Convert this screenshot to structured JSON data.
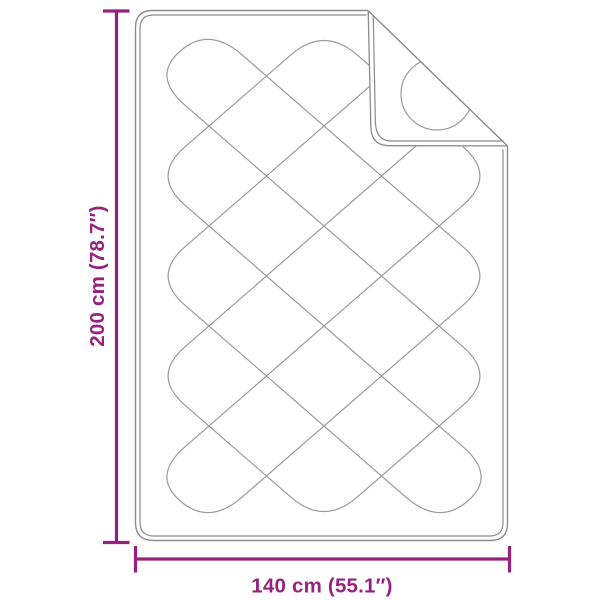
{
  "figure": {
    "alt": "Quilted blanket top view with folded top-right corner",
    "fold_corner": "top-right"
  },
  "dimensions": {
    "height_label": "200 cm (78.7″)",
    "width_label": "140 cm (55.1″)"
  },
  "colors": {
    "background": "#ffffff",
    "dimension": "#96217f",
    "outline": "#8c8c8c",
    "pattern": "#9b9b9b",
    "blanket_fill": "#ffffff"
  }
}
